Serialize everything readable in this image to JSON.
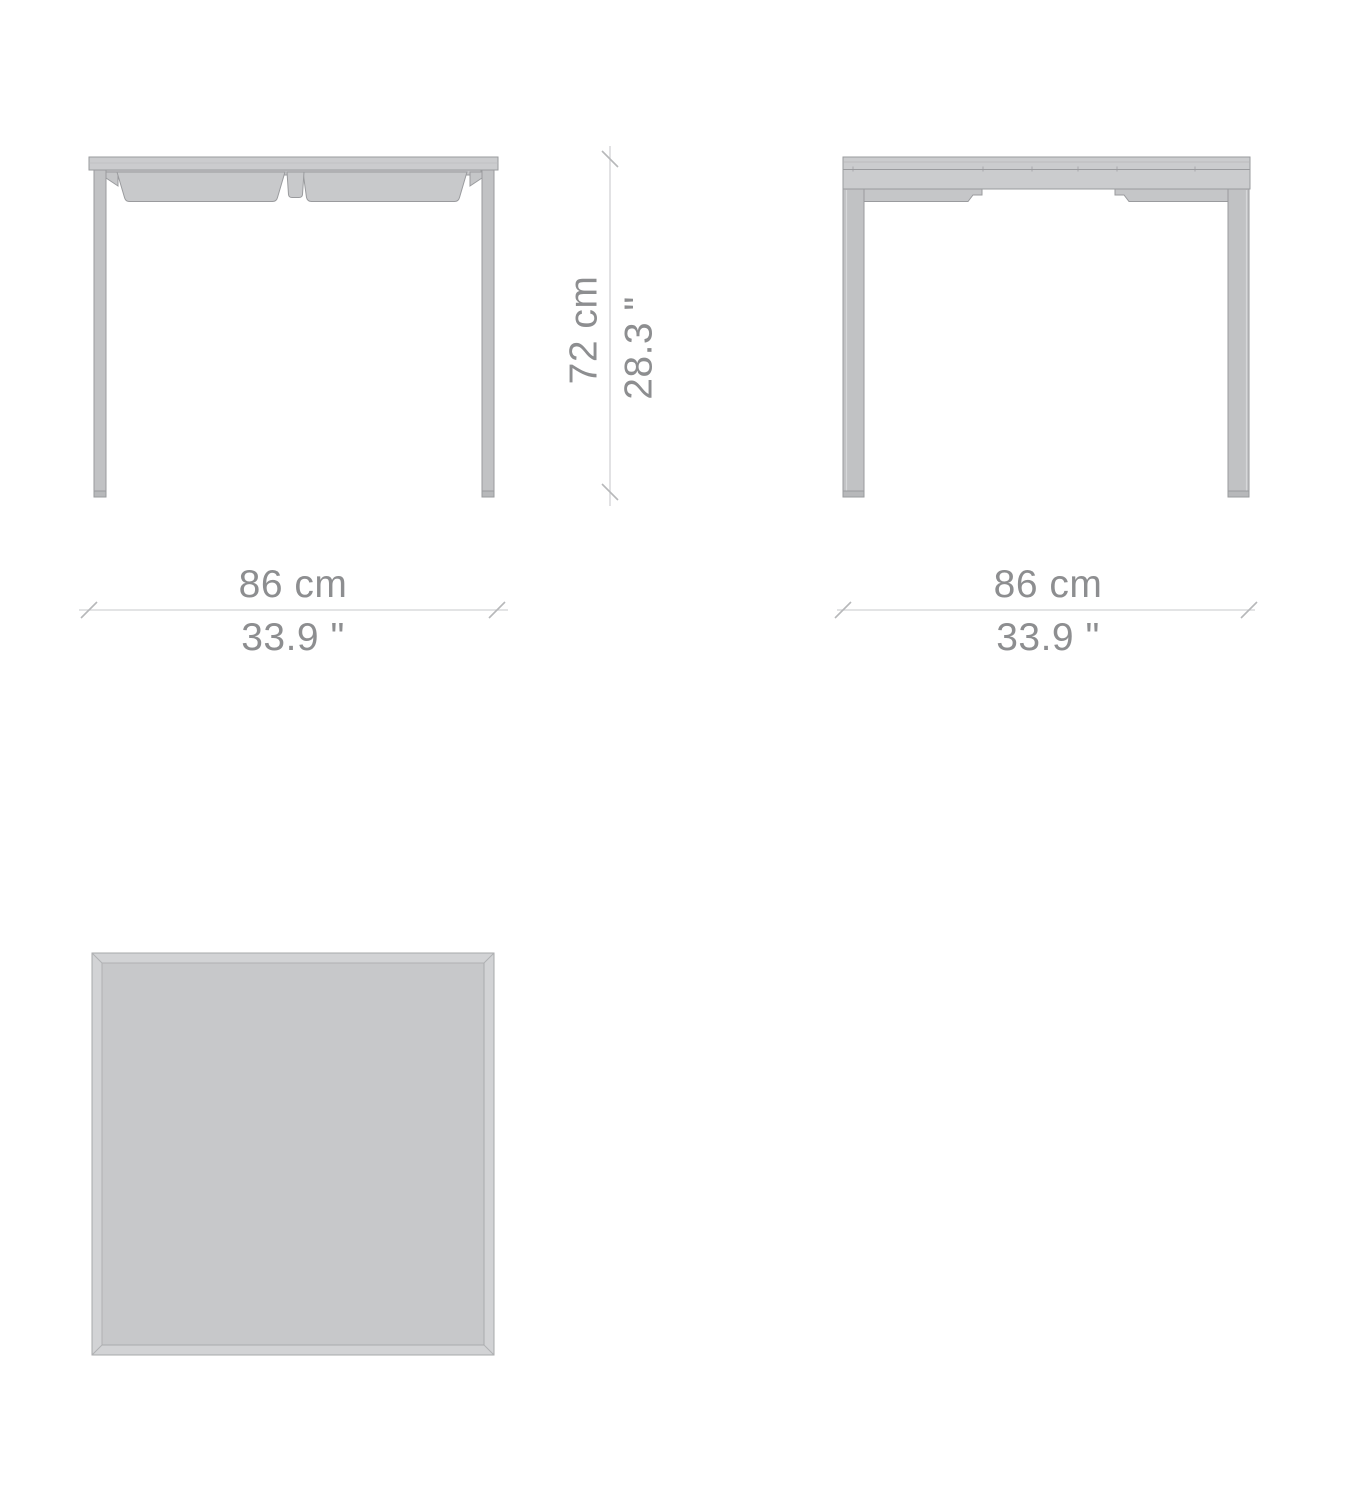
{
  "dimensions": {
    "front_width": {
      "metric": "86 cm",
      "imperial": "33.9 \""
    },
    "side_width": {
      "metric": "86 cm",
      "imperial": "33.9 \""
    },
    "height": {
      "metric": "72 cm",
      "imperial": "28.3 \""
    }
  },
  "colors": {
    "background": "#ffffff",
    "surface_fill": "#cbccce",
    "panel_fill": "#c8c9cb",
    "leg_fill": "#c1c2c4",
    "outline": "#9a9b9e",
    "dimension_line": "#d2d3d5",
    "label_text": "#8d8e90"
  }
}
